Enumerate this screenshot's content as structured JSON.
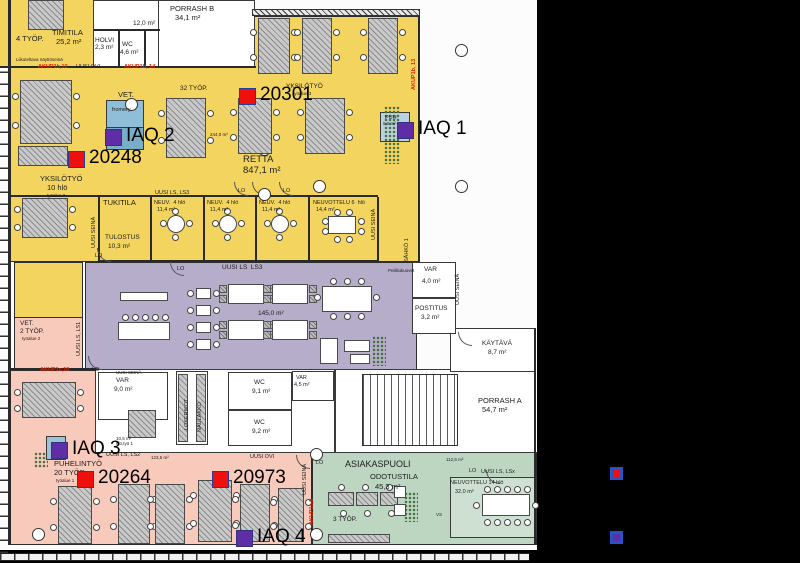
{
  "plan_title": "Office floor plan with IAQ sensor locations",
  "markers": {
    "sensors": [
      {
        "label": "20301",
        "x": 239,
        "y": 88
      },
      {
        "label": "20248",
        "x": 68,
        "y": 151
      },
      {
        "label": "20264",
        "x": 77,
        "y": 471
      },
      {
        "label": "20973",
        "x": 212,
        "y": 471
      }
    ],
    "iaq": [
      {
        "label": "IAQ 1",
        "x": 397,
        "y": 122
      },
      {
        "label": "IAQ 2",
        "x": 105,
        "y": 129
      },
      {
        "label": "IAQ 3",
        "x": 51,
        "y": 442
      },
      {
        "label": "IAQ 4",
        "x": 236,
        "y": 530
      }
    ]
  },
  "legend": {
    "sensor_color": "#ee100d",
    "iaq_color": "#5f2ea6",
    "border_color": "#2953c4",
    "sensor_style": "background:#ee100d;border-color:#2953c4",
    "iaq_style": "background:#5f2ea6;border-color:#2953c4"
  },
  "colors": {
    "zone_open_office": "#f3d45f",
    "zone_lounge": "#b5adca",
    "zone_phone_work": "#f8cabc",
    "zone_customer": "#bcd6c2",
    "reservation_box": "#8fbed8"
  },
  "texts": [
    {
      "t": "PORRASH B",
      "x": 170,
      "y": 5,
      "c": "s7"
    },
    {
      "t": "34,1 m²",
      "x": 175,
      "y": 14,
      "c": "s7"
    },
    {
      "t": "12,0 m²",
      "x": 133,
      "y": 20,
      "c": "s6"
    },
    {
      "t": "4 TYÖP.",
      "x": 16,
      "y": 35,
      "c": "s7"
    },
    {
      "t": "TIMITILA",
      "x": 52,
      "y": 29,
      "c": "s7"
    },
    {
      "t": "25,2 m²",
      "x": 56,
      "y": 38,
      "c": "s7"
    },
    {
      "t": "HOLVI",
      "x": 95,
      "y": 37,
      "c": "s6"
    },
    {
      "t": "2,3 m²",
      "x": 95,
      "y": 44,
      "c": "s6"
    },
    {
      "t": "WC",
      "x": 122,
      "y": 41,
      "c": "s6"
    },
    {
      "t": "4,6 m²",
      "x": 120,
      "y": 49,
      "c": "s6"
    },
    {
      "t": "Liikuteltava näyttöseinä",
      "x": 16,
      "y": 57,
      "c": "s4"
    },
    {
      "t": "AKUP1b,10",
      "x": 38,
      "y": 64,
      "c": "s5 red"
    },
    {
      "t": "UUSI OVI",
      "x": 76,
      "y": 64,
      "c": "s5"
    },
    {
      "t": "AKUP1b, 14",
      "x": 124,
      "y": 64,
      "c": "s5 red"
    },
    {
      "t": "32 TYÖP.",
      "x": 180,
      "y": 85,
      "c": "s6"
    },
    {
      "t": "VET.",
      "x": 118,
      "y": 91,
      "c": "s7"
    },
    {
      "t": "fromery",
      "x": 112,
      "y": 107,
      "c": "s5"
    },
    {
      "t": "YKSILÖTYÖ",
      "x": 286,
      "y": 83,
      "c": "s6"
    },
    {
      "t": "työalue 3",
      "x": 293,
      "y": 91,
      "c": "s4"
    },
    {
      "t": "244,0 m²",
      "x": 210,
      "y": 132,
      "c": "s4"
    },
    {
      "t": "RETTA",
      "x": 243,
      "y": 155,
      "c": "s9"
    },
    {
      "t": "847,1 m²",
      "x": 243,
      "y": 166,
      "c": "s9"
    },
    {
      "t": "YKSILÖTYÖ",
      "x": 40,
      "y": 175,
      "c": "s7"
    },
    {
      "t": "10 hlö",
      "x": 47,
      "y": 184,
      "c": "s7"
    },
    {
      "t": "työalue 2",
      "x": 47,
      "y": 193,
      "c": "s4"
    },
    {
      "t": "PUH",
      "x": 385,
      "y": 115,
      "c": "s5"
    },
    {
      "t": "5,0 m²",
      "x": 383,
      "y": 121,
      "c": "s4"
    },
    {
      "t": "AKUP1b, 13",
      "x": 411,
      "y": 90,
      "c": "s5 red vert"
    },
    {
      "t": "UUSI LS, LS3",
      "x": 155,
      "y": 190,
      "c": "s5"
    },
    {
      "t": "TUKITILA",
      "x": 103,
      "y": 199,
      "c": "s7"
    },
    {
      "t": "NEUV.  4 hlö",
      "x": 154,
      "y": 200,
      "c": "s5"
    },
    {
      "t": "11,4 m²",
      "x": 157,
      "y": 207,
      "c": "s5"
    },
    {
      "t": "NEUV.  4 hlö",
      "x": 207,
      "y": 200,
      "c": "s5"
    },
    {
      "t": "11,4 m²",
      "x": 210,
      "y": 207,
      "c": "s5"
    },
    {
      "t": "NEUV.  4 hlö",
      "x": 259,
      "y": 200,
      "c": "s5"
    },
    {
      "t": "11,4 m²",
      "x": 262,
      "y": 207,
      "c": "s5"
    },
    {
      "t": "NEUVOTTELU 6  hlö",
      "x": 313,
      "y": 200,
      "c": "s5"
    },
    {
      "t": "14,4 m²",
      "x": 316,
      "y": 207,
      "c": "s5"
    },
    {
      "t": "TULOSTUS",
      "x": 105,
      "y": 234,
      "c": "s6"
    },
    {
      "t": "10,3 m²",
      "x": 108,
      "y": 243,
      "c": "s6"
    },
    {
      "t": "UUSI SEINÄ",
      "x": 91,
      "y": 248,
      "c": "s5 vert"
    },
    {
      "t": "UUSI SEINÄ",
      "x": 371,
      "y": 240,
      "c": "s5 vert"
    },
    {
      "t": "SÄHKÖ 1",
      "x": 404,
      "y": 262,
      "c": "s5 vert"
    },
    {
      "t": "UUSI SEINÄ",
      "x": 455,
      "y": 305,
      "c": "s5 vert"
    },
    {
      "t": "LO",
      "x": 95,
      "y": 253,
      "c": "s5"
    },
    {
      "t": "LO",
      "x": 238,
      "y": 188,
      "c": "s5"
    },
    {
      "t": "LO",
      "x": 283,
      "y": 188,
      "c": "s5"
    },
    {
      "t": "LO",
      "x": 177,
      "y": 266,
      "c": "s5"
    },
    {
      "t": "UUSI LS  LS3",
      "x": 222,
      "y": 264,
      "c": "s6"
    },
    {
      "t": "Peililiukuovet",
      "x": 388,
      "y": 268,
      "c": "s4"
    },
    {
      "t": "VAR",
      "x": 424,
      "y": 266,
      "c": "s6"
    },
    {
      "t": "4,0 m²",
      "x": 422,
      "y": 278,
      "c": "s6"
    },
    {
      "t": "POSTITUS",
      "x": 415,
      "y": 305,
      "c": "s6"
    },
    {
      "t": "3,2 m²",
      "x": 421,
      "y": 314,
      "c": "s6"
    },
    {
      "t": "KÄYTÄVÄ",
      "x": 482,
      "y": 340,
      "c": "s6"
    },
    {
      "t": "8,7 m²",
      "x": 488,
      "y": 349,
      "c": "s6"
    },
    {
      "t": "145,0 m²",
      "x": 258,
      "y": 310,
      "c": "s6"
    },
    {
      "t": "VET.",
      "x": 20,
      "y": 320,
      "c": "s6"
    },
    {
      "t": "2 TYÖP.",
      "x": 20,
      "y": 328,
      "c": "s6"
    },
    {
      "t": "työalue 2",
      "x": 22,
      "y": 336,
      "c": "s4"
    },
    {
      "t": "UUSI LS, LS1",
      "x": 76,
      "y": 356,
      "c": "s5 vert"
    },
    {
      "t": "AKUP1c,10",
      "x": 40,
      "y": 367,
      "c": "s5 red"
    },
    {
      "t": "LO",
      "x": 92,
      "y": 367,
      "c": "s5"
    },
    {
      "t": "UUSI SEINÄ",
      "x": 116,
      "y": 370,
      "c": "s4"
    },
    {
      "t": "VAR",
      "x": 116,
      "y": 377,
      "c": "s6"
    },
    {
      "t": "9,0 m²",
      "x": 114,
      "y": 386,
      "c": "s6"
    },
    {
      "t": "LOKERIKOT",
      "x": 184,
      "y": 430,
      "c": "s5 vert"
    },
    {
      "t": "NAULAKKO",
      "x": 197,
      "y": 432,
      "c": "s5 vert"
    },
    {
      "t": "WC",
      "x": 254,
      "y": 379,
      "c": "s6"
    },
    {
      "t": "9,1 m²",
      "x": 252,
      "y": 388,
      "c": "s6"
    },
    {
      "t": "WC",
      "x": 254,
      "y": 419,
      "c": "s6"
    },
    {
      "t": "9,2 m²",
      "x": 252,
      "y": 428,
      "c": "s6"
    },
    {
      "t": "VAR",
      "x": 296,
      "y": 375,
      "c": "s5"
    },
    {
      "t": "4,5 m²",
      "x": 294,
      "y": 382,
      "c": "s5"
    },
    {
      "t": "PORRASH A",
      "x": 478,
      "y": 397,
      "c": "s7"
    },
    {
      "t": "54,7 m²",
      "x": 482,
      "y": 406,
      "c": "s7"
    },
    {
      "t": "UUSI OVI",
      "x": 250,
      "y": 454,
      "c": "s5"
    },
    {
      "t": "UUSI SEINÄ",
      "x": 302,
      "y": 495,
      "c": "s5 vert"
    },
    {
      "t": "AKUP1c,9",
      "x": 309,
      "y": 525,
      "c": "s5 red vert"
    },
    {
      "t": "10,5 m²",
      "x": 116,
      "y": 436,
      "c": "s4"
    },
    {
      "t": "hlö,työ 1",
      "x": 116,
      "y": 441,
      "c": "s4"
    },
    {
      "t": "UUSI LS, LS2",
      "x": 106,
      "y": 452,
      "c": "s5"
    },
    {
      "t": "123,5 m²",
      "x": 151,
      "y": 455,
      "c": "s4"
    },
    {
      "t": "PUHELINTYÖ",
      "x": 54,
      "y": 460,
      "c": "s7"
    },
    {
      "t": "20 TYÖP.",
      "x": 54,
      "y": 469,
      "c": "s7"
    },
    {
      "t": "työalue 1",
      "x": 56,
      "y": 478,
      "c": "s4"
    },
    {
      "t": "LO",
      "x": 316,
      "y": 460,
      "c": "s5"
    },
    {
      "t": "ASIAKASPUOLI",
      "x": 345,
      "y": 459,
      "c": "s8"
    },
    {
      "t": "ODOTUSTILA",
      "x": 370,
      "y": 473,
      "c": "s7"
    },
    {
      "t": "45,3 m²",
      "x": 375,
      "y": 483,
      "c": "s7"
    },
    {
      "t": "112,5 m²",
      "x": 446,
      "y": 457,
      "c": "s4"
    },
    {
      "t": "LO",
      "x": 469,
      "y": 468,
      "c": "s5"
    },
    {
      "t": "UUSI LS, LSx",
      "x": 481,
      "y": 469,
      "c": "s5"
    },
    {
      "t": "NEUVOTTELU 14 hlö",
      "x": 450,
      "y": 480,
      "c": "s5"
    },
    {
      "t": "32,0 m²",
      "x": 455,
      "y": 489,
      "c": "s5"
    },
    {
      "t": "3 TYÖP.",
      "x": 333,
      "y": 516,
      "c": "s6"
    },
    {
      "t": "VS",
      "x": 436,
      "y": 512,
      "c": "s4"
    }
  ]
}
